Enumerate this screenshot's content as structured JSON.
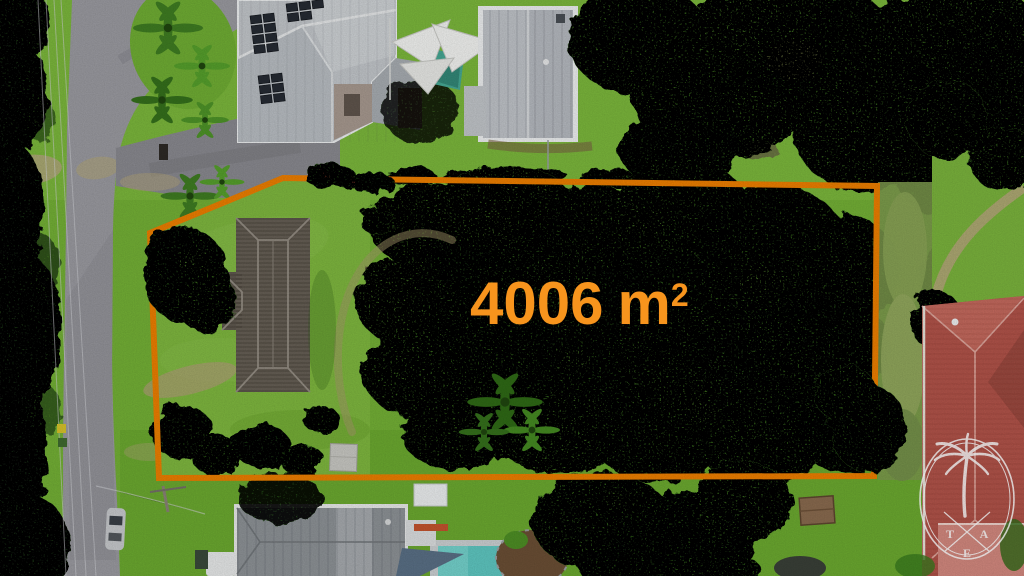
{
  "scene": {
    "area_label": {
      "value": "4006",
      "unit": "m",
      "exponent": "2"
    },
    "watermark": {
      "letter_left": "T",
      "letter_right": "A",
      "letter_bottom": "E"
    },
    "colors": {
      "boundary": "#EE7F00",
      "area_text": "#F7941D",
      "watermark": "#FFFFFF",
      "lawn": "#7CB53C",
      "canopy": "#55992B",
      "road": "#9B9BA1",
      "roof_light_gray": "#C3C7CB",
      "roof_dark_shingle": "#5F584F",
      "roof_terracotta": "#B5574A",
      "pool_water": "#5CC8C0"
    }
  }
}
